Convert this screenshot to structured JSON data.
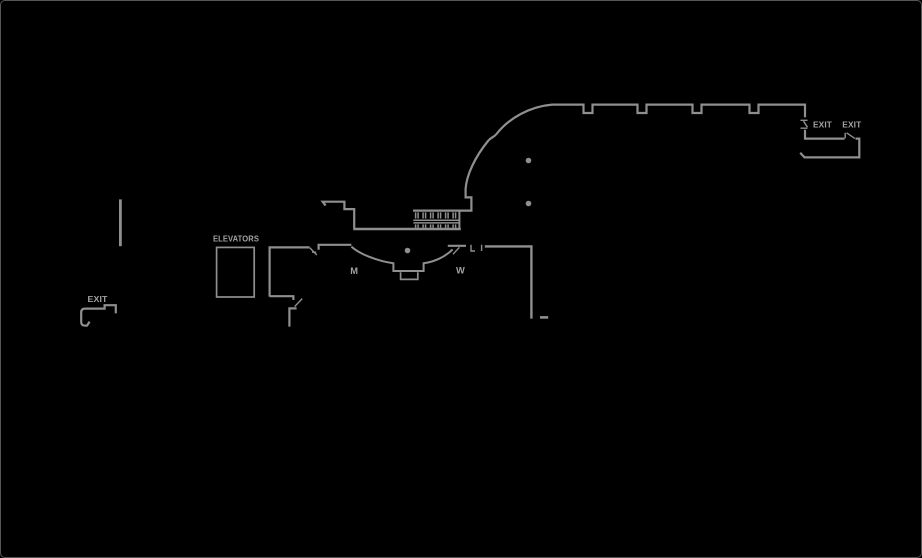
{
  "canvas": {
    "background": "#000000",
    "border_color": "#565656"
  },
  "colors": {
    "line": "#8f8f8f",
    "text": "#a2a2a2"
  },
  "floor_plan": {
    "labels": {
      "elevators": "ELEVATORS",
      "exit_left": "EXIT",
      "exit_top_right_1": "EXIT",
      "exit_top_right_2": "EXIT",
      "restroom_men": "M",
      "restroom_women": "W"
    }
  }
}
